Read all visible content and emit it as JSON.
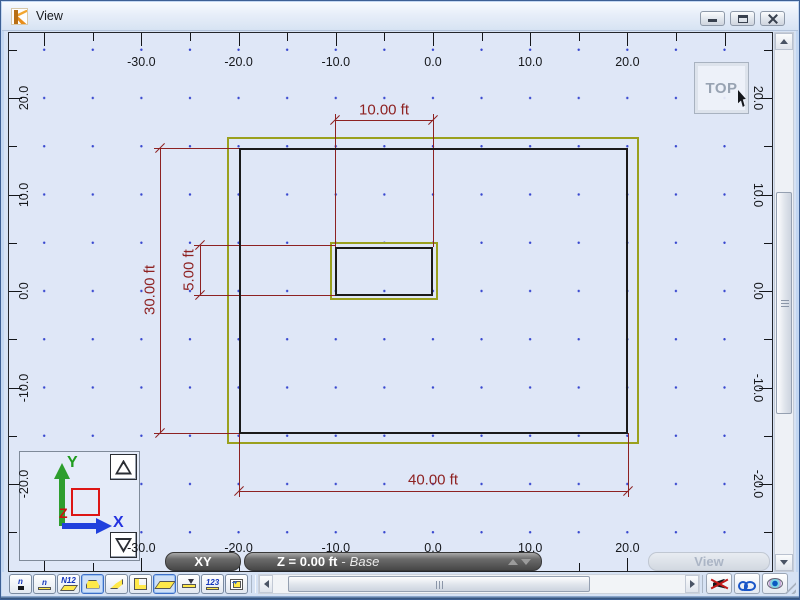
{
  "window": {
    "title": "View",
    "controls": {
      "minimize": "minimize",
      "restore": "restore",
      "close": "close"
    }
  },
  "canvas": {
    "view_orientation": "TOP"
  },
  "rulers": {
    "top": [
      "-30.0",
      "-20.0",
      "-10.0",
      "0.0",
      "10.0",
      "20.0"
    ],
    "bottom": [
      "-30.0",
      "-20.0",
      "-10.0",
      "0.0",
      "10.0",
      "20.0"
    ],
    "left": [
      "20.0",
      "10.0",
      "0.0",
      "-10.0",
      "-20.0"
    ],
    "right": [
      "20.0",
      "10.0",
      "0.0",
      "-10.0",
      "-20.0"
    ]
  },
  "drawing": {
    "slab_width_ft": 40,
    "slab_height_ft": 30,
    "opening_width_ft": 10,
    "opening_height_ft": 5
  },
  "dimensions": [
    {
      "label": "10.00 ft",
      "orientation": "horizontal"
    },
    {
      "label": "5.00 ft",
      "orientation": "vertical"
    },
    {
      "label": "30.00 ft",
      "orientation": "vertical"
    },
    {
      "label": "40.00 ft",
      "orientation": "horizontal"
    }
  ],
  "status": {
    "plane_label": "XY",
    "z_label": "Z = 0.00 ft",
    "separator": "-",
    "layer_label": "Base",
    "view_button": "View"
  },
  "axis_widget": {
    "x_label": "X",
    "y_label": "Y",
    "z_label": "Z"
  },
  "toolbar": {
    "buttons": [
      {
        "name": "node-numbers-icon",
        "text": "n",
        "shape": "dot",
        "selected": false
      },
      {
        "name": "member-numbers-icon",
        "text": "n",
        "shape": "underline",
        "selected": false
      },
      {
        "name": "section-labels-icon",
        "text": "N12",
        "shape": "para",
        "selected": false
      },
      {
        "name": "supports-icon",
        "text": "",
        "shape": "tent",
        "selected": true
      },
      {
        "name": "plates-icon",
        "text": "",
        "shape": "fold",
        "selected": false
      },
      {
        "name": "releases-icon",
        "text": "",
        "shape": "angle",
        "selected": false
      },
      {
        "name": "slabs-icon",
        "text": "",
        "shape": "para-big",
        "selected": true
      },
      {
        "name": "distributed-load-icon",
        "text": "",
        "shape": "beam",
        "selected": false
      },
      {
        "name": "dimensions-icon",
        "text": "123",
        "shape": "underline",
        "selected": false
      },
      {
        "name": "pan-grid-icon",
        "text": "",
        "shape": "grid",
        "selected": false
      }
    ]
  },
  "view_buttons": [
    {
      "name": "hide-entities-button"
    },
    {
      "name": "view-glasses-button"
    },
    {
      "name": "perspective-eye-button"
    }
  ],
  "colors": {
    "dimension": "#8e2222",
    "slab_edge": "#9aa01e",
    "wall_line": "#1a1a1a",
    "grid_dot": "#2f3fd4",
    "canvas_bg": "#dfe7f7",
    "selected_accent": "#3d6fc8"
  }
}
